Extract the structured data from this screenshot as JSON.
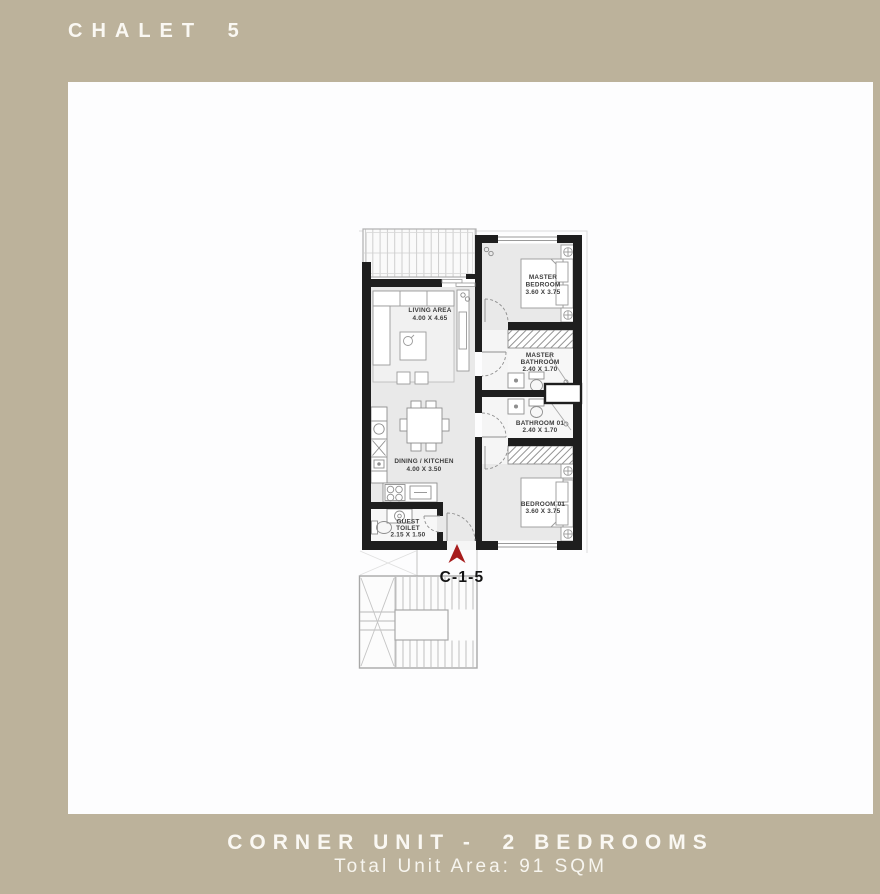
{
  "title": "CHALET 5",
  "footer": {
    "line1": "CORNER UNIT -  2 BEDROOMS",
    "line2": "Total Unit Area: 91 SQM"
  },
  "unit_marker": {
    "label": "C-1-5",
    "arrow_icon": "north-arrow-icon"
  },
  "rooms": {
    "living_area": {
      "line1": "LIVING AREA",
      "line2": "4.00 X 4.65"
    },
    "dining_kitchen": {
      "line1": "DINING / KITCHEN",
      "line2": "4.00 X 3.50"
    },
    "guest_toilet": {
      "line1": "GUEST",
      "line2": "TOILET",
      "line3": "2.15 X 1.50"
    },
    "master_bedroom": {
      "line1": "MASTER",
      "line2": "BEDROOM",
      "line3": "3.60 X 3.75"
    },
    "master_bathroom": {
      "line1": "MASTER",
      "line2": "BATHROOM",
      "line3": "2.40 X 1.70"
    },
    "bathroom_01": {
      "line1": "BATHROOM 01",
      "line2": "2.40 X 1.70"
    },
    "bedroom_01": {
      "line1": "BEDROOM 01",
      "line2": "3.60 X 3.75"
    }
  },
  "colors": {
    "background": "#bcb29b",
    "card": "#fdfdfe",
    "wall": "#1e1e1e",
    "floor": "#e9e9e9",
    "accent_red": "#a81d1d",
    "text_light": "#faf8f3"
  }
}
